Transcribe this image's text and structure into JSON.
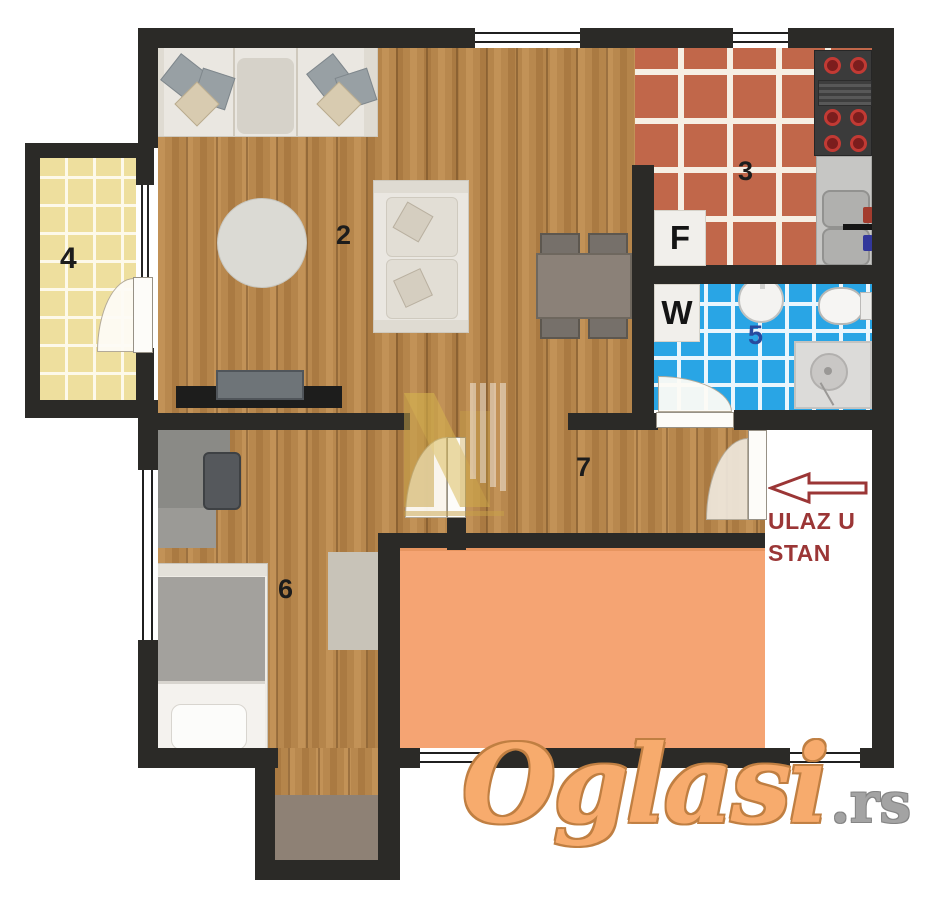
{
  "plan": {
    "title": "apartment-floor-plan",
    "rooms": [
      {
        "key": "living_room",
        "number": "2"
      },
      {
        "key": "kitchen",
        "number": "3"
      },
      {
        "key": "balcony",
        "number": "4"
      },
      {
        "key": "bathroom",
        "number": "5"
      },
      {
        "key": "bedroom",
        "number": "6"
      },
      {
        "key": "hallway",
        "number": "7"
      }
    ],
    "markers": {
      "fridge": "F",
      "washing_machine": "W"
    },
    "entrance": {
      "label_line1": "ULAZ U",
      "label_line2": "STAN",
      "direction": "left"
    },
    "colors": {
      "wall": "#2b2a27",
      "wood_floor": "#b8884e",
      "kitchen_tile": "#c1674a",
      "bathroom_tile": "#29a5e5",
      "balcony_tile": "#eedf9e",
      "terrace_fill": "#f5a473",
      "entrance_text": "#9b3636",
      "bathroom_number": "#274a9e"
    }
  },
  "watermark": {
    "brand": "Oglasi",
    "suffix": ".rs"
  }
}
